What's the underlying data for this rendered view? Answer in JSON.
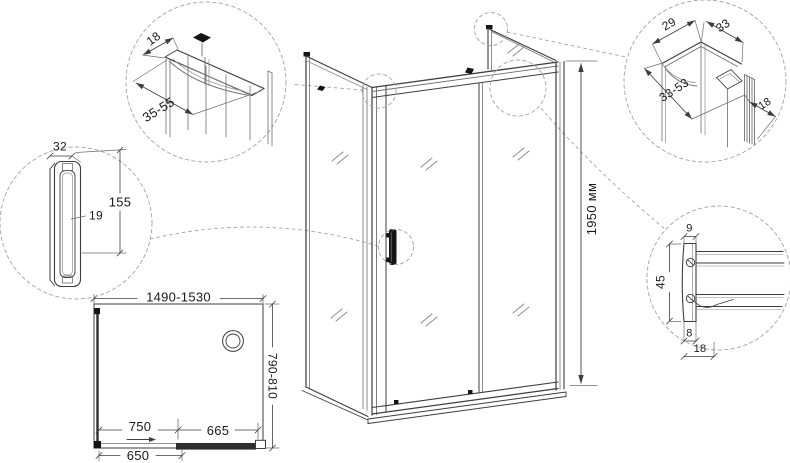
{
  "iso_view": {
    "height": "1950 мм"
  },
  "plan_view": {
    "width": "1490-1530",
    "depth": "790-810",
    "door_panel": "750",
    "fixed_panel": "665",
    "opening": "650"
  },
  "detail_wall_profile_top": {
    "width": "18",
    "adjust_range": "35-55"
  },
  "detail_handle": {
    "width": "32",
    "length": "155",
    "gap": "19"
  },
  "detail_corner_profile": {
    "width_front": "29",
    "width_side": "33",
    "adjust_range": "33-53",
    "wall_profile": "18"
  },
  "detail_guide_rail": {
    "width_top": "9",
    "height": "45",
    "width_bottom": "8",
    "width_total": "18"
  },
  "colors": {
    "line": "#3d3d3d",
    "leader": "#a3a3a3",
    "text": "#1a1a1a",
    "accent": "#141414"
  }
}
